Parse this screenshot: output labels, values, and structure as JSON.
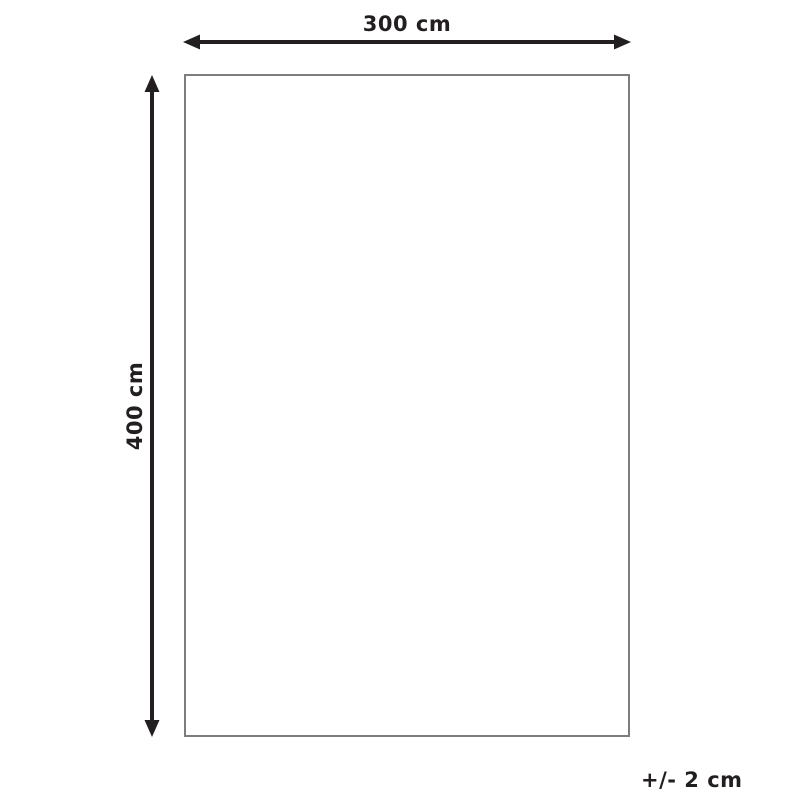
{
  "diagram": {
    "width_label": "300 cm",
    "height_label": "400 cm",
    "tolerance_label": "+/- 2 cm",
    "colors": {
      "arrow": "#231f20",
      "text": "#231f20",
      "rect_border": "#7d7d80",
      "background": "#ffffff"
    }
  }
}
